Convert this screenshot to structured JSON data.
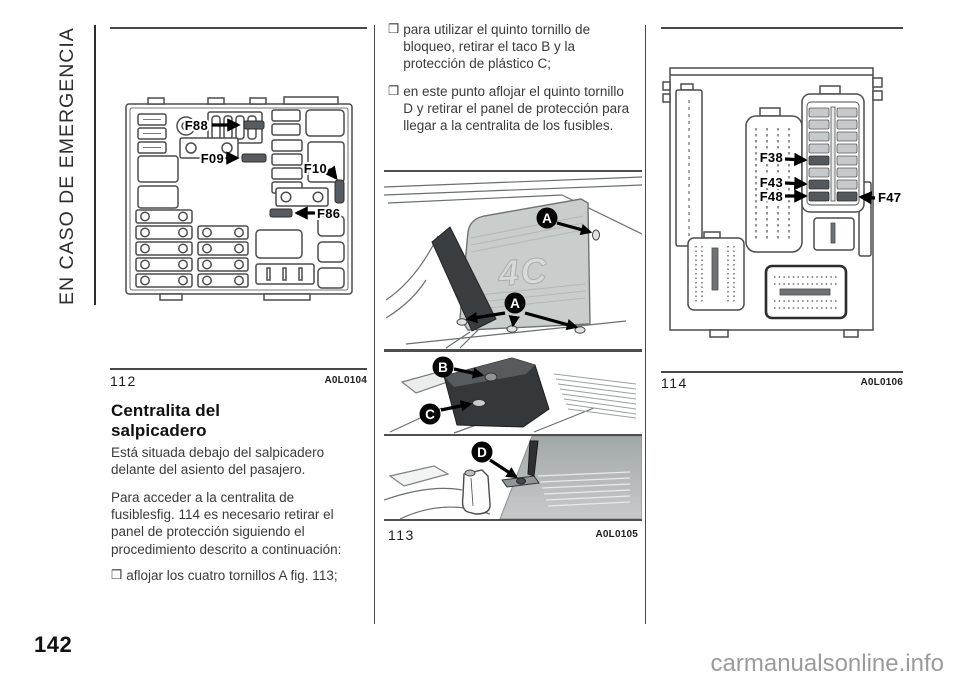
{
  "page": {
    "number": "142",
    "section_label": "EN CASO DE EMERGENCIA",
    "watermark": "carmanualsonline.info"
  },
  "bullet_char": "❒",
  "column1": {
    "figure": {
      "number": "112",
      "code": "A0L0104",
      "labels": {
        "f88": "F88",
        "f09": "F09",
        "f10": "F10",
        "f86": "F86"
      }
    },
    "heading": "Centralita del\nsalpicadero",
    "paragraphs": [
      "Está situada debajo del salpicadero\ndelante del asiento del pasajero.",
      "Para acceder a la centralita de\nfusiblesfig. 114 es necesario retirar el\npanel de protección siguiendo el\nprocedimiento descrito a continuación:"
    ],
    "bullets": [
      "aflojar los cuatro tornillos A fig. 113;"
    ]
  },
  "column2": {
    "bullets": [
      "para utilizar el quinto tornillo de\nbloqueo, retirar el taco B y la\nprotección de plástico C;",
      "en este punto aflojar el quinto tornillo\nD y retirar el panel de protección para\nllegar a la centralita de los fusibles."
    ],
    "figure": {
      "number": "113",
      "code": "A0L0105",
      "panel_logo": "4C",
      "callouts": {
        "a": "A",
        "b": "B",
        "c": "C",
        "d": "D"
      }
    }
  },
  "column3": {
    "figure": {
      "number": "114",
      "code": "A0L0106",
      "labels": {
        "f38": "F38",
        "f43": "F43",
        "f48": "F48",
        "f47": "F47"
      }
    }
  },
  "colors": {
    "text": "#3a3a3a",
    "rule": "#474747",
    "dark_fuse": "#575c60",
    "cover_gray": "#c9cdcb",
    "cover_dark": "#34383b",
    "carpet_gray": "#bfc3c3",
    "watermark": "#9b9b9b"
  }
}
